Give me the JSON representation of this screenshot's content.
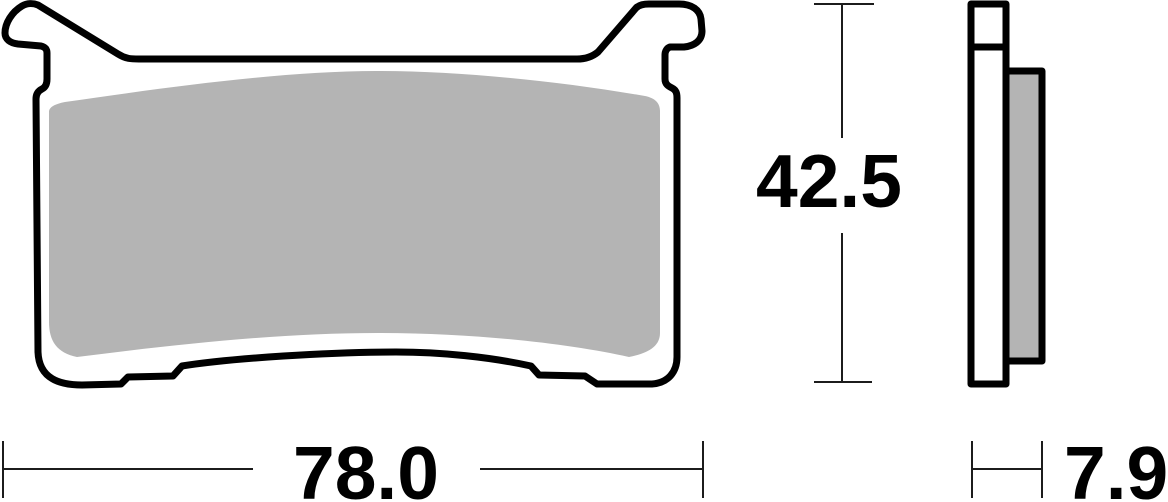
{
  "drawing": {
    "subject": "brake-pad-technical-drawing",
    "views": {
      "front_view": "front-profile-of-brake-pad",
      "side_view": "edge-profile-of-brake-pad"
    },
    "dimensions": {
      "width": "78.0",
      "height": "42.5",
      "thickness": "7.9"
    },
    "colors": {
      "outline": "#000000",
      "friction_material": "#b4b4b4",
      "plate_fill": "#ffffff",
      "dimension_line": "#1c1c1c",
      "text": "#000000"
    }
  }
}
